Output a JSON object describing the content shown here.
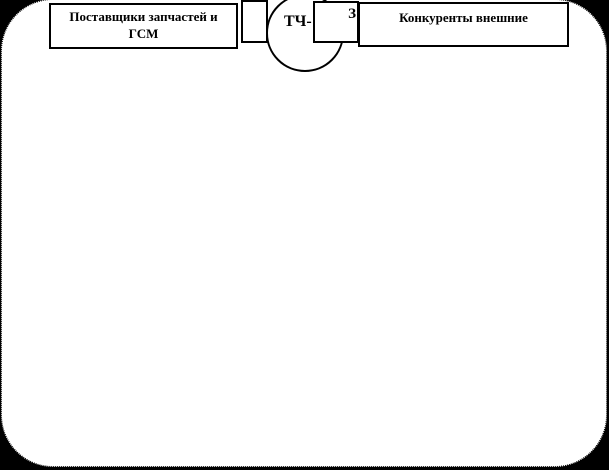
{
  "diagram": {
    "type": "environment-scheme-fragment",
    "colors": {
      "background": "#000000",
      "surface": "#ffffff",
      "stroke": "#000000",
      "text": "#000000"
    },
    "nodes": {
      "suppliers_box": {
        "label": "Поставщики запчастей и ГСМ"
      },
      "connector_box": {
        "label": ""
      },
      "center_circle": {
        "label": "ТЧ-"
      },
      "z_box": {
        "label": "З"
      },
      "competitors_box": {
        "label": "Конкуренты внешние"
      }
    }
  }
}
